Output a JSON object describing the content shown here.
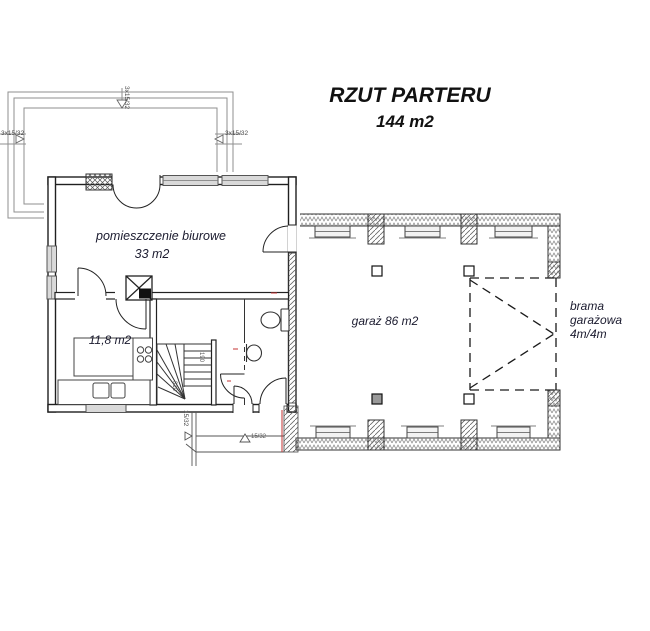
{
  "title": {
    "main": "RZUT PARTERU",
    "area": "144 m2"
  },
  "labels": {
    "office_name": "pomieszczenie biurowe",
    "office_area": "33 m2",
    "kitchen_area": "11,8 m2",
    "garage": "garaż 86 m2",
    "gate_line1": "brama",
    "gate_line2": "garażowa",
    "gate_line3": "4m/4m"
  },
  "annotations": {
    "terrace_steps_left": "3x15/32",
    "terrace_steps_right": "3x15/32",
    "terrace_steps_top": "3x15/32",
    "entry_steps_side": "15/32",
    "entry_steps_front": "15/32",
    "stair_dim_a": "190",
    "stair_dim_b": "310"
  },
  "colors": {
    "wall_line": "#1f1f1f",
    "terrace_line": "#8f8f8f",
    "window_fill": "#d9d9d9",
    "label_text": "#1b1b2f",
    "accent_red": "#c43333"
  }
}
